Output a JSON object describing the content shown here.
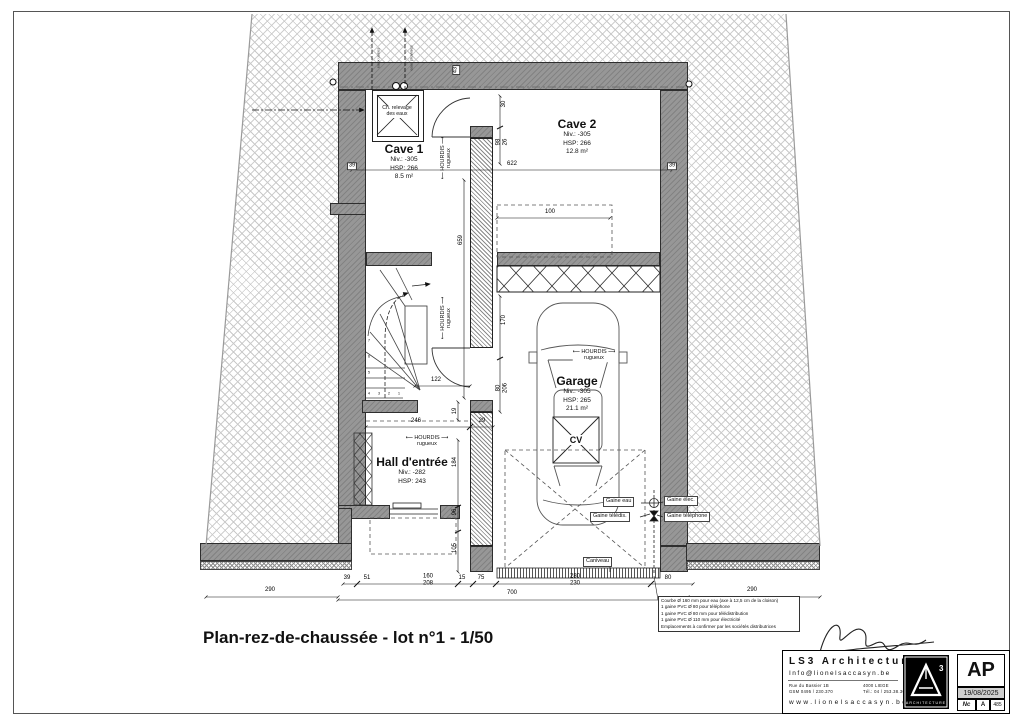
{
  "sheet": {
    "title": "Plan-rez-de-chaussée - lot n°1 - 1/50"
  },
  "rooms": {
    "cave1": {
      "name": "Cave 1",
      "niv": "Niv.: -305",
      "hsp": "HSP: 266",
      "area": "8.5 m²"
    },
    "cave2": {
      "name": "Cave 2",
      "niv": "Niv.: -305",
      "hsp": "HSP: 266",
      "area": "12.8 m²"
    },
    "garage": {
      "name": "Garage",
      "niv": "Niv.: -305",
      "hsp": "HSP: 265",
      "area": "21.1 m²"
    },
    "hall": {
      "name": "Hall d'entrée",
      "niv": "Niv.: -282",
      "hsp": "HSP: 243"
    }
  },
  "equipment": {
    "sump_l1": "Ch. relevage",
    "sump_l2": "des eaux",
    "cv": "CV",
    "caniveau": "Caniveau"
  },
  "gaines": {
    "eau": "Gaine eau",
    "teledis": "Gaine télédis.",
    "elec": "Gaine élec.",
    "tel": "Gaine téléphone"
  },
  "hourdis": {
    "l1": "HOURDIS",
    "l2": "rugueux"
  },
  "pipes": {
    "p1": "eaux usées",
    "p2": "eaux pluviales"
  },
  "stairs": {
    "numbers": [
      "1",
      "2",
      "3",
      "4",
      "5",
      "6",
      "7"
    ]
  },
  "dims": {
    "w622": "622",
    "t39l": "39",
    "t39r": "39",
    "t43": "43",
    "v30": "30",
    "v98": "98",
    "v26": "26",
    "w100": "100",
    "v659": "659",
    "v170": "170",
    "v80": "80",
    "v206": "206",
    "w122": "122",
    "v19": "19",
    "w246": "246",
    "w29": "29",
    "v184": "184",
    "v96": "96",
    "v105": "105",
    "b39": "39",
    "b51": "51",
    "b160": "160",
    "b208": "208",
    "b15": "15",
    "b75": "75",
    "b280": "280",
    "b230": "230",
    "b80": "80",
    "b700": "700",
    "b290l": "290",
    "b290r": "290"
  },
  "notes": {
    "lines": [
      "Courbe Ø 160 mm pour eau (axe à 12,5 cm de la cloison)",
      "1 gaine PVC Ø 80 pour téléphone",
      "1 gaine PVC Ø 80 mm  pour télédistribution",
      "1 gaine PVC Ø 110 mm pour électricité",
      "Emplacements à confirmer par les sociétés distributrices"
    ]
  },
  "titleblock": {
    "firm": "LS3  Architecture",
    "email": "Info@lionelsaccasyn.be",
    "addr_l1": "Rue du Bassier  1B",
    "addr_r1": "4000 LIEGE",
    "addr_l2": "GSM 0495 / 230.370",
    "addr_r2": "Tél.: 04 / 253.38.30",
    "web": "www.lionelsaccasyn.be",
    "logo_caption": "ARCHITECTURE",
    "stamp": "AP",
    "date": "19/08/2025",
    "idx1": "Nc",
    "idx2": "A",
    "idx3": "485"
  }
}
